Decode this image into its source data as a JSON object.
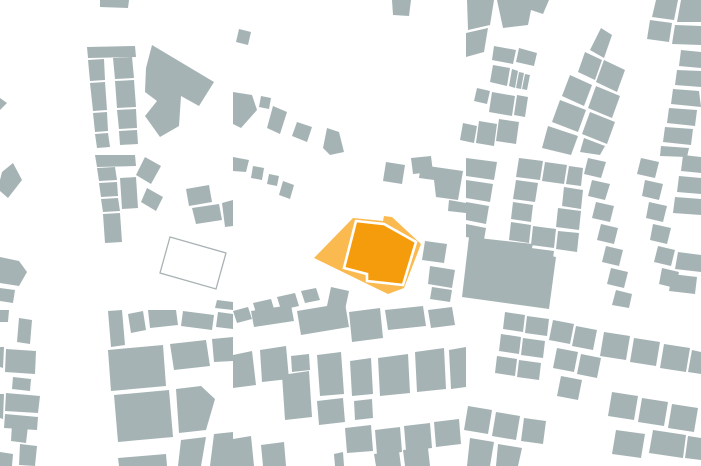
{
  "canvas": {
    "width": 701,
    "height": 466
  },
  "map": {
    "type": "figure-ground-site-plan",
    "background_color": "#ffffff",
    "building_color": "#a6b3b5",
    "site": {
      "parcel_color": "#fbba50",
      "building_color": "#f59c0d",
      "building_outline_color": "#ffffff",
      "building_outline_width": 2.6,
      "parcel_points": "314,258 353,218 383,221 384,216 392,217 421,244 404,288 388,294",
      "building_points": "356,221 384,224 416,242 403,285 367,281 367,274 344,268"
    },
    "vacant_parcel": {
      "stroke_color": "#a9b2b4",
      "stroke_width": 1.3,
      "points": "170,237 226,253 216,289 160,273"
    },
    "buildings": [
      "100,0 129,0 128,8 100,7",
      "87,47 135,46 136,57 88,58",
      "88,60 104,59 105,80 90,81",
      "90,83 105,82 107,110 93,111",
      "93,113 107,112 108,131 95,132",
      "95,134 108,133 110,147 97,148",
      "113,58 132,57 134,78 115,79",
      "115,81 134,80 136,107 117,108",
      "117,110 136,109 137,128 119,129",
      "119,131 137,130 138,144 120,145",
      "152,45 214,82 199,106 181,96 179,126 160,137 145,116 157,101 145,92 146,68",
      "0,98 7,103 0,110",
      "239,29 251,32 248,45 236,42",
      "392,0 411,0 409,16 393,15",
      "233,92 252,95 257,110 241,128 233,124",
      "261,96 271,98 269,109 259,107",
      "273,106 287,112 280,134 267,128",
      "297,122 312,127 307,142 292,136",
      "327,128 339,132 344,152 330,155 323,148",
      "233,157 249,160 246,172 233,171",
      "253,166 264,168 262,180 251,178",
      "269,174 279,176 277,186 267,184",
      "283,181 294,185 290,199 279,195",
      "2,172 13,163 22,180 8,198 0,191 0,180",
      "95,155 135,155 136,166 97,167",
      "97,168 115,167 117,180 99,181",
      "99,183 117,182 118,196 101,197",
      "101,199 118,198 120,211 103,212",
      "120,178 136,177 138,208 122,209",
      "103,214 120,213 122,242 105,243",
      "145,157 161,166 151,184 136,175",
      "147,188 163,197 156,211 141,202",
      "186,189 209,185 212,202 189,206",
      "192,208 219,204 222,220 196,224",
      "222,203 233,200 233,226 225,227",
      "0,257 19,261 27,272 19,286 0,283",
      "0,288 15,290 13,303 0,301",
      "217,300 233,302 233,310 215,308",
      "386,162 405,165 402,184 383,181",
      "411,158 431,156 433,172 413,174",
      "421,165 463,171 458,200 436,197 434,180 419,178",
      "449,200 466,203 466,213 448,211",
      "425,241 447,244 444,263 422,260",
      "430,266 455,270 452,288 428,284",
      "432,287 452,290 450,302 430,299",
      "233,311 248,307 252,319 237,323",
      "253,303 271,299 275,312 257,316",
      "277,297 295,293 299,306 281,310",
      "301,291 316,288 320,300 305,303",
      "331,287 349,291 345,310 327,306",
      "467,0 494,0 490,25 468,30",
      "466,33 488,28 484,52 466,57",
      "497,0 549,0 543,14 531,10 528,25 503,28",
      "494,46 516,50 513,64 492,60",
      "519,48 537,53 534,66 516,62",
      "493,65 510,68 507,86 490,82",
      "512,69 518,71 515,88 509,86",
      "519,72 524,73 521,89 516,88",
      "525,74 530,75 527,90 522,89",
      "477,88 490,91 487,104 474,101",
      "492,92 515,96 512,116 489,112",
      "517,95 528,97 525,117 514,115",
      "463,123 477,126 474,143 460,140",
      "479,121 497,124 494,146 476,143",
      "499,119 519,122 516,144 496,141",
      "601,28 612,35 604,58 590,50",
      "585,52 602,60 595,80 578,72",
      "604,60 625,70 617,92 596,82",
      "570,75 592,85 584,106 562,96",
      "596,86 620,96 612,118 588,108",
      "560,100 586,110 578,132 552,122",
      "590,112 615,122 607,144 582,134",
      "548,126 578,136 571,155 542,148",
      "584,138 605,146 600,155 580,152",
      "656,0 678,0 674,20 652,17",
      "681,0 701,0 701,22 677,22",
      "650,20 672,23 669,42 647,39",
      "675,25 701,26 701,45 672,44",
      "681,50 701,52 701,68 679,66",
      "677,70 701,71 701,87 675,85",
      "673,89 699,91 701,107 671,104",
      "669,108 697,110 695,126 667,123",
      "665,127 693,129 691,145 663,142",
      "661,146 689,148 687,157 660,156",
      "466,158 497,162 494,180 466,176",
      "466,180 493,184 490,202 466,198",
      "466,202 489,206 486,224 466,220",
      "466,224 486,228 484,240 466,237",
      "469,237 533,244 531,252 556,257 549,309 462,297",
      "519,158 543,161 540,180 516,177",
      "545,162 567,165 564,184 542,181",
      "569,166 583,168 581,186 566,184",
      "516,180 538,183 535,202 513,199",
      "564,187 583,190 581,209 562,206",
      "513,202 533,205 531,222 511,219",
      "558,208 581,211 579,230 556,227",
      "511,222 531,225 529,243 509,240",
      "533,226 556,229 554,248 531,245",
      "558,231 579,233 577,252 556,249",
      "509,244 529,247 527,262 507,259",
      "531,248 554,251 552,266 529,263",
      "588,158 606,162 601,178 584,174",
      "592,180 610,184 605,200 588,196",
      "596,202 614,206 610,222 592,218",
      "601,224 618,228 614,244 597,240",
      "606,246 623,250 619,266 602,262",
      "611,268 628,272 624,288 607,284",
      "616,290 632,294 629,308 612,305",
      "641,158 659,162 655,178 637,174",
      "645,180 663,184 659,200 642,196",
      "649,202 667,206 663,222 646,218",
      "653,224 671,228 667,244 650,240",
      "658,246 675,250 671,266 654,262",
      "662,268 679,272 675,288 659,284",
      "683,155 701,157 701,173 681,171",
      "679,176 701,178 701,194 677,192",
      "675,197 701,199 701,215 673,213",
      "678,252 701,255 701,272 675,269",
      "672,274 697,277 695,294 669,291",
      "251,311 291,305 294,321 254,327",
      "297,311 345,303 349,327 301,335",
      "349,312 380,308 383,338 352,342",
      "385,310 423,306 426,326 388,330",
      "428,310 452,307 455,325 431,328",
      "233,355 252,351 256,385 233,388",
      "260,350 286,346 289,379 262,382",
      "282,375 309,371 312,417 285,420",
      "291,356 309,354 310,370 292,372",
      "317,355 341,352 344,394 320,396",
      "317,401 343,398 345,422 319,425",
      "350,361 371,358 373,394 352,396",
      "354,401 372,399 373,418 355,420",
      "378,358 408,354 410,393 380,396",
      "415,352 444,348 446,389 417,392",
      "449,350 466,347 466,387 451,389",
      "345,428 371,425 373,451 347,453",
      "375,430 400,427 402,452 377,455",
      "404,426 430,423 432,448 406,451",
      "434,422 459,419 461,444 436,447",
      "334,454 343,452 344,466 335,466",
      "374,454 399,451 401,466 376,466",
      "403,450 428,448 430,466 405,466",
      "233,439 251,436 254,466 233,466",
      "261,445 284,442 286,466 263,466",
      "505,312 525,315 523,332 503,329",
      "527,316 549,319 547,336 525,333",
      "501,334 521,337 519,354 499,351",
      "523,338 545,341 543,358 521,355",
      "497,356 517,359 515,376 495,373",
      "519,360 541,363 539,380 517,377",
      "553,320 574,324 570,344 549,340",
      "576,326 597,330 593,350 572,346",
      "557,348 578,352 574,372 553,368",
      "581,354 601,358 597,378 577,374",
      "561,376 582,380 578,400 557,396",
      "604,332 630,336 626,360 600,356",
      "634,338 660,342 656,366 630,362",
      "664,344 690,348 686,372 660,368",
      "692,350 701,352 701,374 688,372",
      "612,392 638,396 634,420 608,416",
      "642,398 668,402 664,426 638,422",
      "672,404 698,408 694,432 668,428",
      "653,430 686,435 683,458 649,453",
      "616,430 645,434 641,458 612,454",
      "688,436 701,438 701,460 685,458",
      "468,406 492,410 488,434 464,430",
      "496,412 520,416 516,440 492,436",
      "470,438 494,442 490,466 467,466",
      "498,444 522,448 518,466 496,466",
      "524,418 546,421 543,444 521,441",
      "0,310 9,310 8,322 0,322",
      "19,318 32,320 30,344 17,342",
      "0,347 4,347 3,368 0,367",
      "6,349 36,351 35,374 5,372",
      "13,377 31,379 30,391 12,389",
      "0,394 4,394 3,419 0,418",
      "6,393 40,396 38,413 5,411",
      "5,414 38,417 37,430 4,428",
      "12,424 28,426 26,443 11,441",
      "20,444 37,446 35,466 19,465",
      "0,452 13,454 12,466 0,466",
      "108,311 122,310 125,345 111,347",
      "128,314 143,311 146,330 131,333",
      "148,310 176,310 178,325 150,328",
      "183,311 214,315 212,330 181,326",
      "218,312 233,314 233,329 216,327",
      "108,350 163,345 166,386 111,391",
      "170,344 206,340 210,366 174,370",
      "212,339 233,337 233,361 214,362",
      "114,395 169,390 173,437 118,442",
      "176,389 201,386 215,399 206,430 179,433",
      "118,458 166,454 167,466 119,466",
      "181,440 206,437 201,466 178,466",
      "214,434 233,432 233,466 210,466"
    ]
  }
}
